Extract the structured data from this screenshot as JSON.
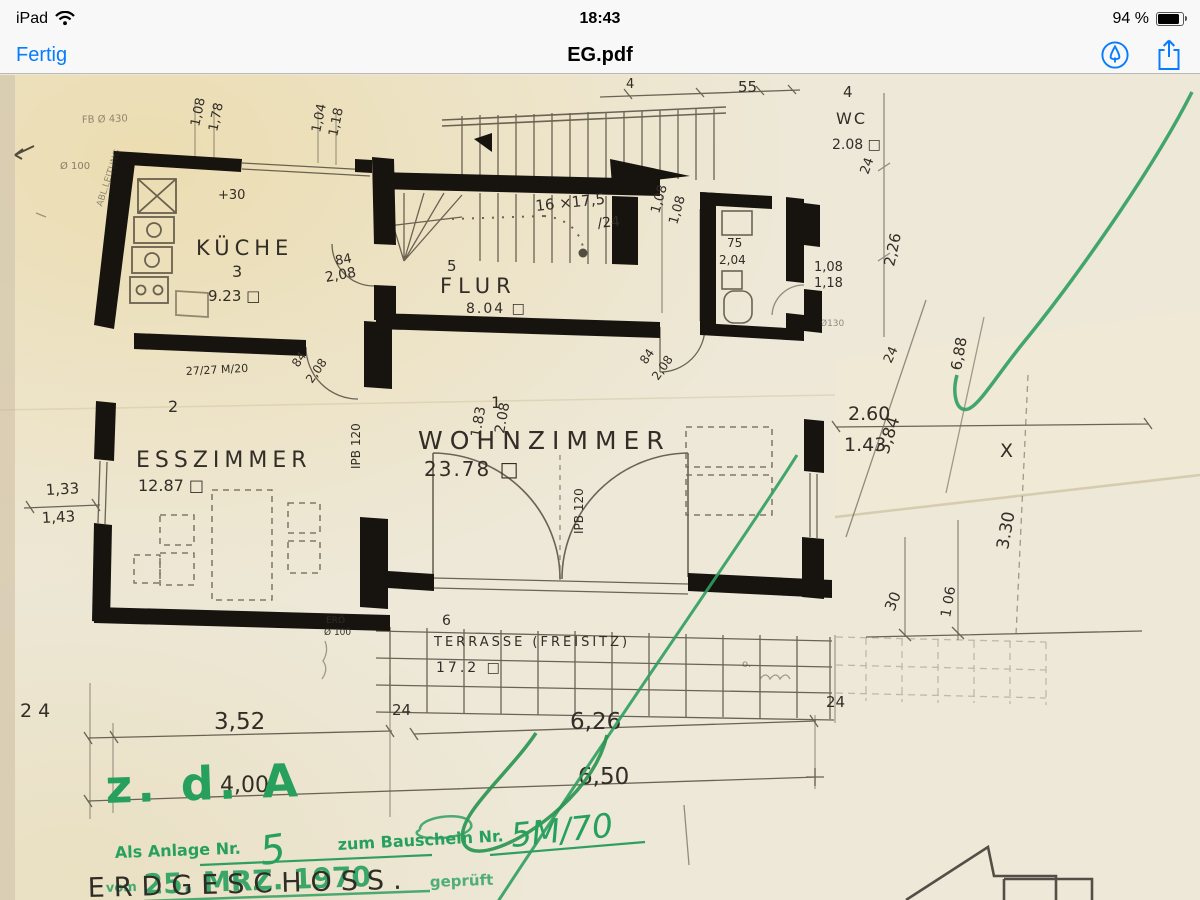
{
  "status_bar": {
    "carrier": "iPad",
    "time": "18:43",
    "battery": "94 %"
  },
  "nav_bar": {
    "done_label": "Fertig",
    "title": "EG.pdf"
  },
  "plan": {
    "rooms": {
      "kueche": {
        "no": "3",
        "name": "KÜCHE",
        "area": "9.23 □"
      },
      "flur": {
        "no": "5",
        "name": "FLUR",
        "area": "8.04 □"
      },
      "wc": {
        "no": "4",
        "name": "WC",
        "area": "2.08 □"
      },
      "wohnzimmer": {
        "no": "1",
        "name": "WOHNZIMMER",
        "area": "23.78 □"
      },
      "esszimmer": {
        "no": "2",
        "name": "ESSZIMMER",
        "area": "12.87 □"
      },
      "terrasse": {
        "no": "6",
        "name": "TERRASSE (FREISITZ)",
        "area": "17.2 □"
      }
    },
    "stairs": {
      "note": "16 ×17,5",
      "note2": "/24"
    },
    "dims": {
      "k_win1a": "1,08",
      "k_win1b": "1,78",
      "k_win2a": "1,04",
      "k_win2b": "1,18",
      "top_4": "4",
      "top_55": "55",
      "plus30": "+30",
      "kd_a": "84",
      "kd_b": "2,08",
      "st_r_a": "1,08",
      "st_r_b": "1,08",
      "wc_in_a": "75",
      "wc_in_b": "2,04",
      "wc_r_a": "1,08",
      "wc_r_b": "1,18",
      "r24a": "24",
      "r226": "2,26",
      "d130": "Ø130",
      "fd_a": "84",
      "fd_b": "2,08",
      "chimney": "27/27 M/20",
      "kd2_a": "84",
      "kd2_b": "2,08",
      "es_win_a": "1,33",
      "es_win_b": "1,43",
      "r260": "2.60",
      "r143": "1.43",
      "r384": "3,84",
      "r24b": "24",
      "r688": "6,88",
      "x_mark": "X",
      "r330": "3.30",
      "r30": "30",
      "r106": "1 06",
      "ipb1": "IPB 120",
      "ipb2": "IPB 120",
      "fdoor_a": "1.83",
      "fdoor_b": "2.08",
      "ero": "ERÖ",
      "ero_d": "Ø 100",
      "b24a": "2 4",
      "b352": "3,52",
      "b24b": "24",
      "b626": "6,26",
      "b24c": "24",
      "b400": "4,00",
      "b650": "6,50",
      "fb": "FB Ø 430",
      "d100": "Ø 100",
      "leitung": "ABL.LEITUNG",
      "o_mark": "o."
    },
    "green": {
      "zda": "z. d. A",
      "anlage": "Als Anlage Nr.",
      "anlage_no": "5",
      "bauschein": "zum Bauschein Nr.",
      "bauschein_no": "5M/70",
      "vom": "vom",
      "date": "25. MRZ. 1970",
      "geprueft": "geprüft"
    },
    "erdgeschoss": "ERDGESCHOSS."
  }
}
